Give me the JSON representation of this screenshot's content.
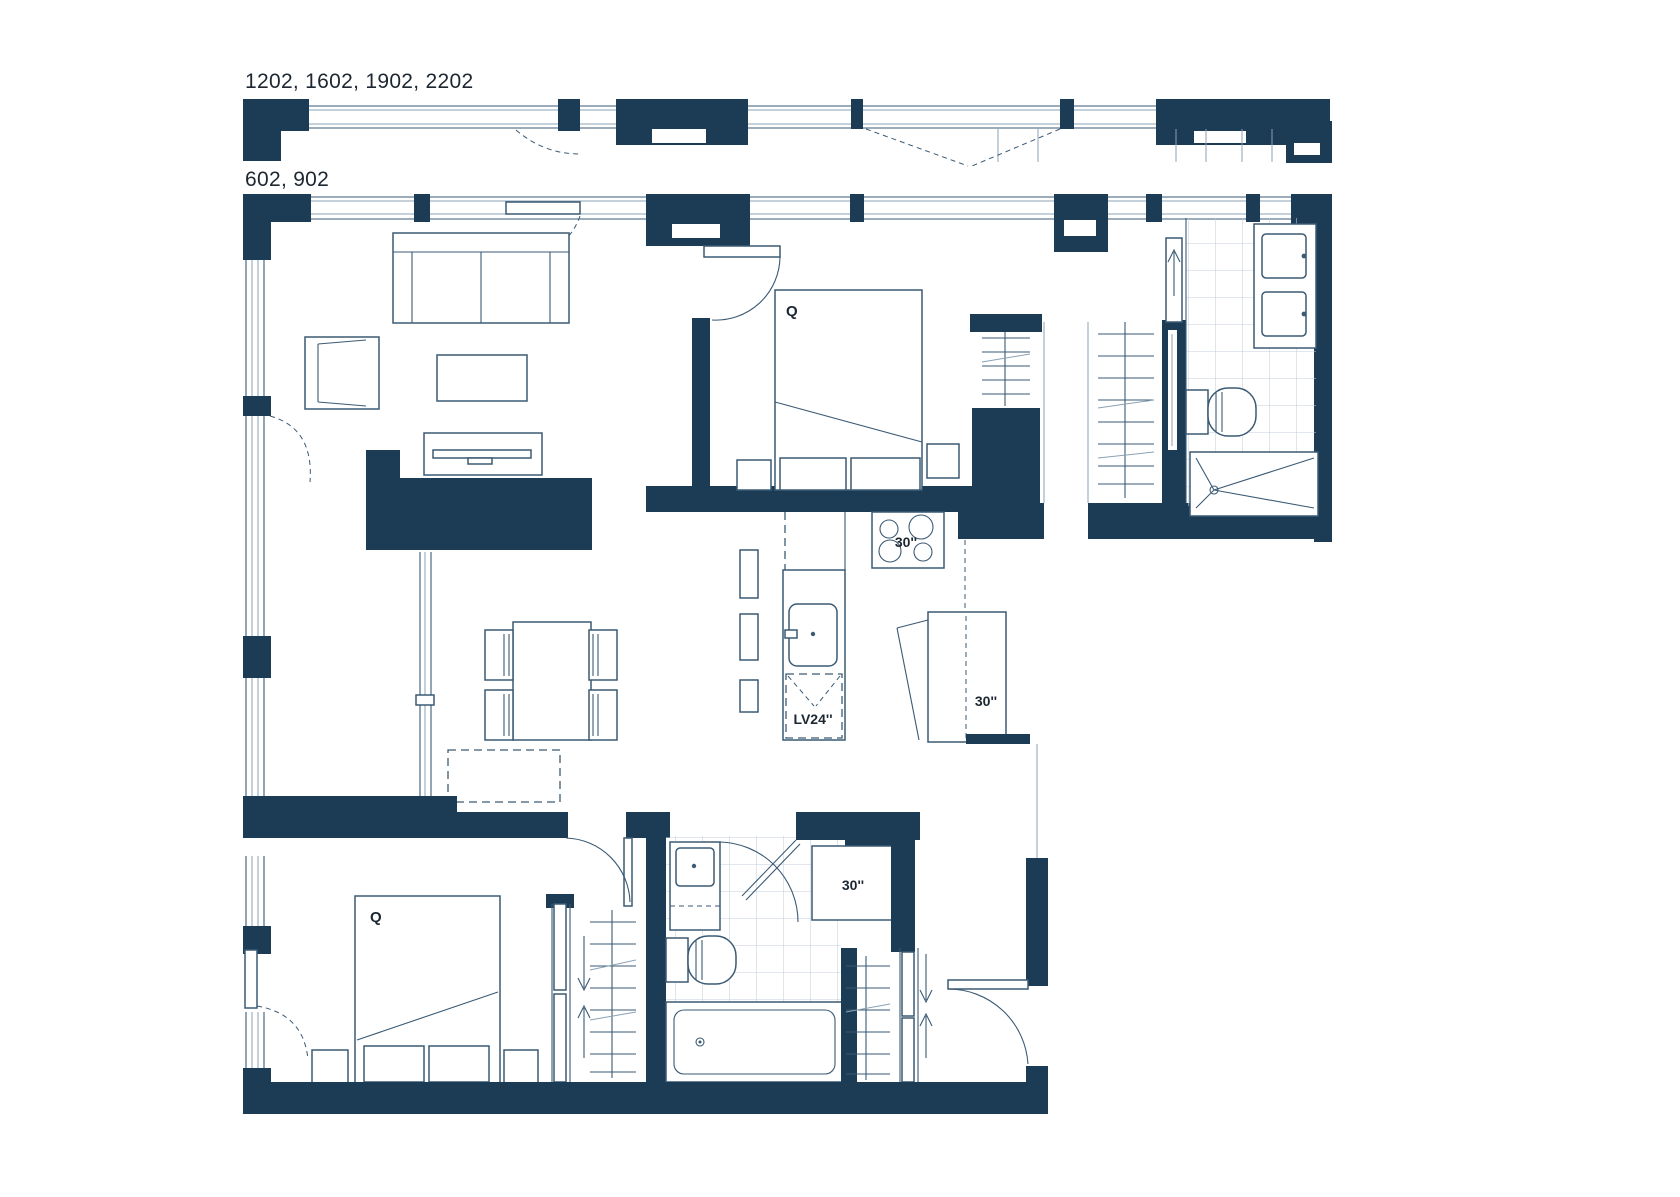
{
  "labels": {
    "floors_a": "1202, 1602, 1902, 2202",
    "floors_b": "602, 902"
  },
  "annotations": {
    "bed_primary": "Q",
    "bed_secondary": "Q",
    "range_width": "30''",
    "fridge_width": "30''",
    "laundry_width": "30''",
    "dishwasher_label": "LV24''"
  },
  "colors": {
    "wall": "#1c3b55",
    "ink": "#3b5a74",
    "light": "#8aa2b4",
    "tile": "#c3cfda",
    "text": "#1d2731",
    "paper": "#ffffff"
  }
}
